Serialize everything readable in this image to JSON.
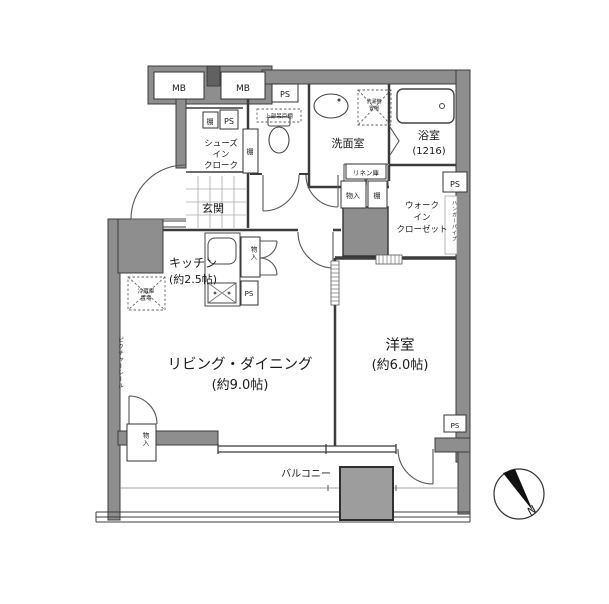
{
  "rooms": {
    "entrance": {
      "label": "玄関"
    },
    "shoes_in_closet": {
      "line1": "シューズ",
      "line2": "イン",
      "line3": "クローク"
    },
    "toilet": {
      "upper_cabinet": "上部吊戸棚"
    },
    "washroom": {
      "label": "洗面室",
      "washer_line1": "洗濯機",
      "washer_line2": "置場"
    },
    "bathroom": {
      "label": "浴室",
      "size": "(1216)"
    },
    "walk_in_closet": {
      "line1": "ウォーク",
      "line2": "イン",
      "line3": "クローゼット",
      "hanger_note": "ハンガーパイプ"
    },
    "kitchen": {
      "label": "キッチン",
      "size": "(約2.5帖)",
      "fridge_line1": "冷蔵庫",
      "fridge_line2": "置場"
    },
    "living_dining": {
      "label": "リビング・ダイニング",
      "size": "(約9.0帖)"
    },
    "western_room": {
      "label": "洋室",
      "size": "(約6.0帖)"
    },
    "balcony": {
      "label": "バルコニー"
    }
  },
  "fixtures": {
    "meter_box": "MB",
    "pipe_space": "PS",
    "shelf": "棚",
    "storage": "物入",
    "linen": "リネン庫",
    "picture_rail": "ピクチャーレール",
    "north": "N"
  },
  "colors": {
    "wall": "#8e8e8e",
    "wall_dark": "#616161",
    "line": "#3c3c3c",
    "background": "#ffffff"
  }
}
